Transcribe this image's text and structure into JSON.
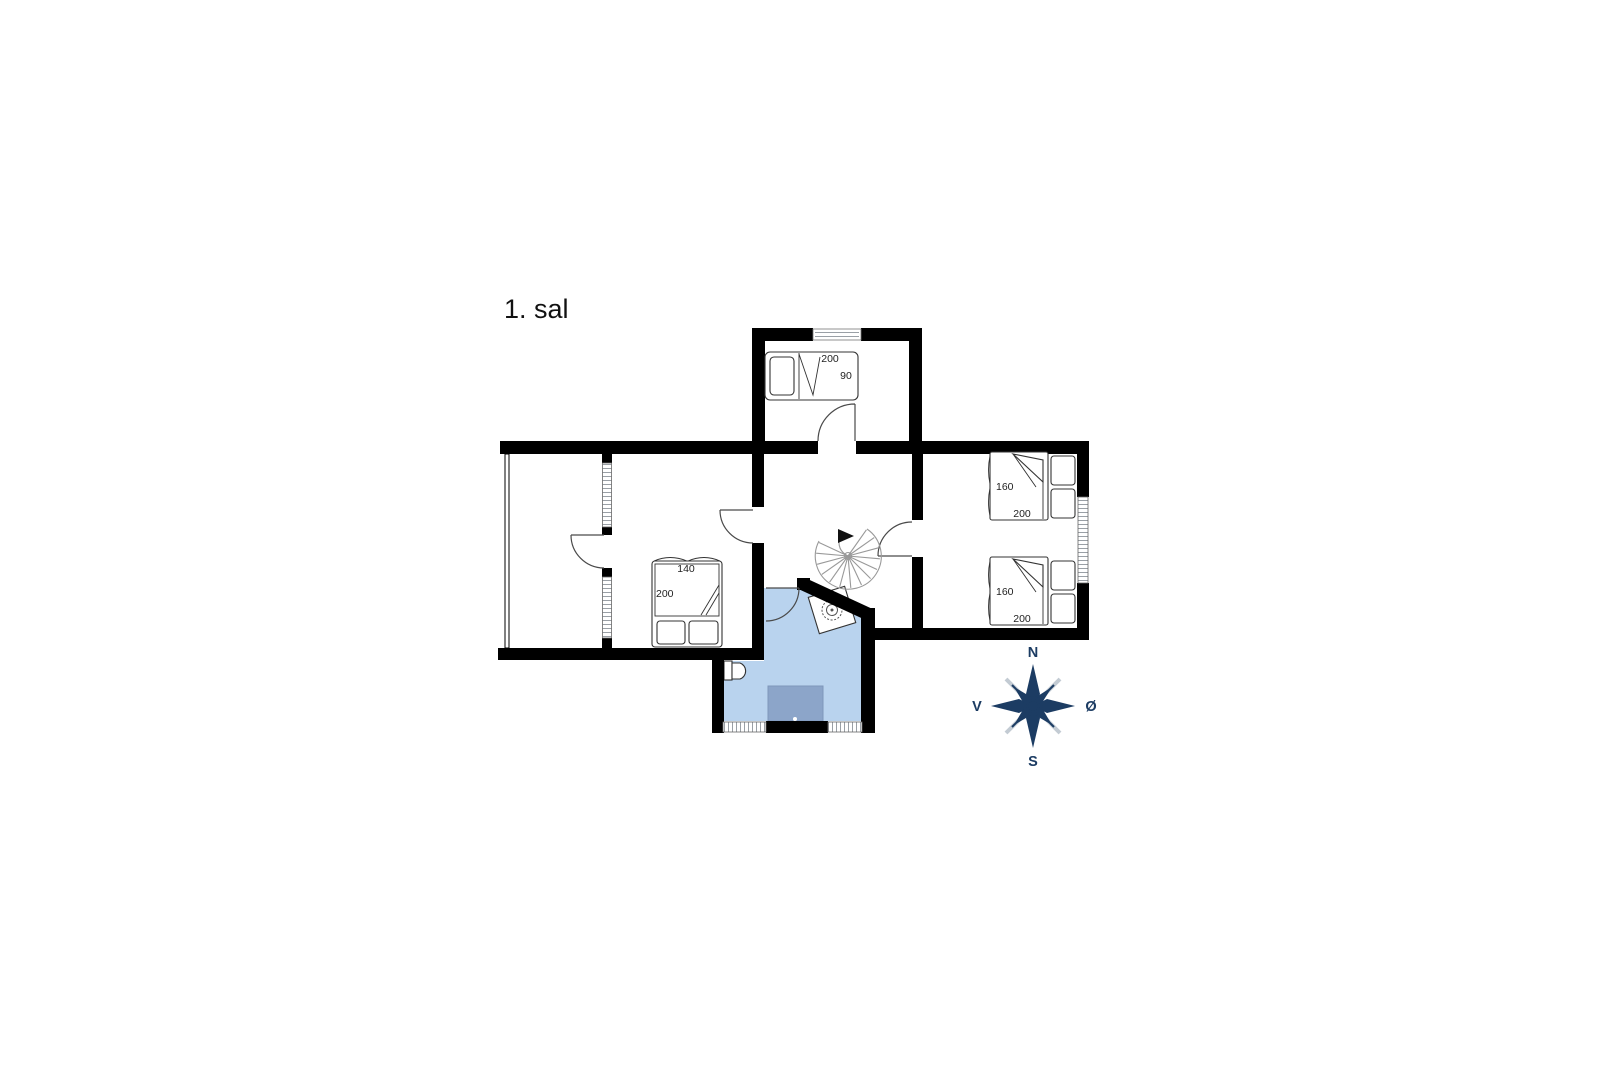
{
  "title": "1. sal",
  "colors": {
    "wall": "#000000",
    "bath": "#b9d3ee",
    "mat": "#8ca5c9",
    "navy": "#1c3c63"
  },
  "beds": {
    "top": {
      "length": "200",
      "width": "90"
    },
    "middle": {
      "width": "140",
      "length": "200"
    },
    "right_upper": {
      "width": "160",
      "length": "200"
    },
    "right_lower": {
      "width": "160",
      "length": "200"
    }
  },
  "compass": {
    "north": "N",
    "south": "S",
    "east": "Ø",
    "west": "V"
  }
}
